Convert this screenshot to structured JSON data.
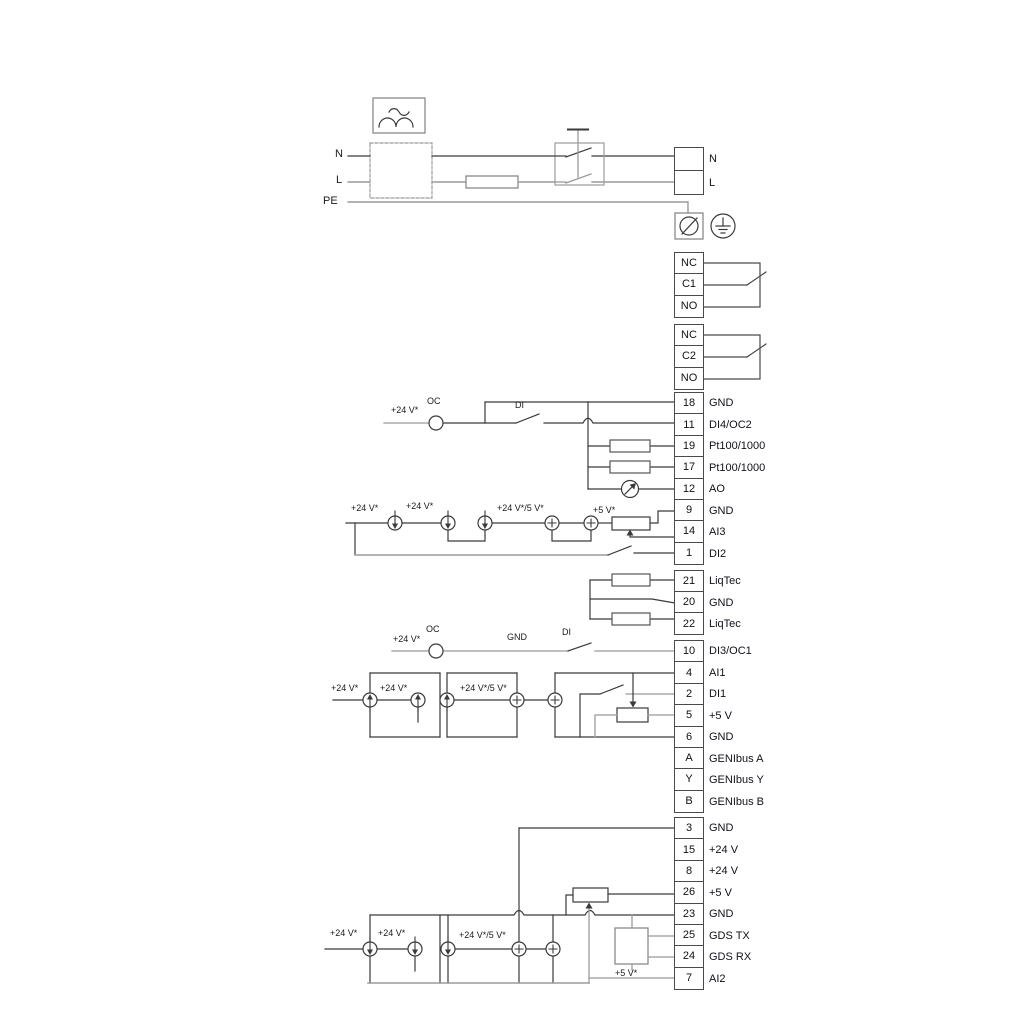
{
  "power_in": {
    "n": "N",
    "l": "L",
    "pe": "PE"
  },
  "power_out": {
    "n": "N",
    "l": "L"
  },
  "wire_labels": {
    "plus24": "+24 V*",
    "plus24_or_5": "+24 V*/5 V*",
    "plus5_star": "+5 V*",
    "oc": "OC",
    "di": "DI",
    "gnd": "GND"
  },
  "relays": [
    {
      "rows": [
        "NC",
        "C1",
        "NO"
      ]
    },
    {
      "rows": [
        "NC",
        "C2",
        "NO"
      ]
    }
  ],
  "strips": {
    "a": {
      "rows": [
        {
          "id": "18",
          "label": "GND"
        },
        {
          "id": "11",
          "label": "DI4/OC2"
        },
        {
          "id": "19",
          "label": "Pt100/1000"
        },
        {
          "id": "17",
          "label": "Pt100/1000"
        },
        {
          "id": "12",
          "label": "AO"
        },
        {
          "id": "9",
          "label": "GND"
        },
        {
          "id": "14",
          "label": "AI3"
        },
        {
          "id": "1",
          "label": "DI2"
        }
      ]
    },
    "b": {
      "rows": [
        {
          "id": "21",
          "label": "LiqTec"
        },
        {
          "id": "20",
          "label": "GND"
        },
        {
          "id": "22",
          "label": "LiqTec"
        }
      ]
    },
    "c": {
      "rows": [
        {
          "id": "10",
          "label": "DI3/OC1"
        },
        {
          "id": "4",
          "label": "AI1"
        },
        {
          "id": "2",
          "label": "DI1"
        },
        {
          "id": "5",
          "label": "+5 V"
        },
        {
          "id": "6",
          "label": "GND"
        },
        {
          "id": "A",
          "label": "GENIbus A"
        },
        {
          "id": "Y",
          "label": "GENIbus Y"
        },
        {
          "id": "B",
          "label": "GENIbus B"
        }
      ]
    },
    "d": {
      "rows": [
        {
          "id": "3",
          "label": "GND"
        },
        {
          "id": "15",
          "label": "+24 V"
        },
        {
          "id": "8",
          "label": "+24 V"
        },
        {
          "id": "26",
          "label": "+5 V"
        },
        {
          "id": "23",
          "label": "GND"
        },
        {
          "id": "25",
          "label": "GDS TX"
        },
        {
          "id": "24",
          "label": "GDS RX"
        },
        {
          "id": "7",
          "label": "AI2"
        }
      ]
    }
  },
  "colors": {
    "wire_dark": "#3a3a3a",
    "wire_gray": "#9b9b9b"
  }
}
